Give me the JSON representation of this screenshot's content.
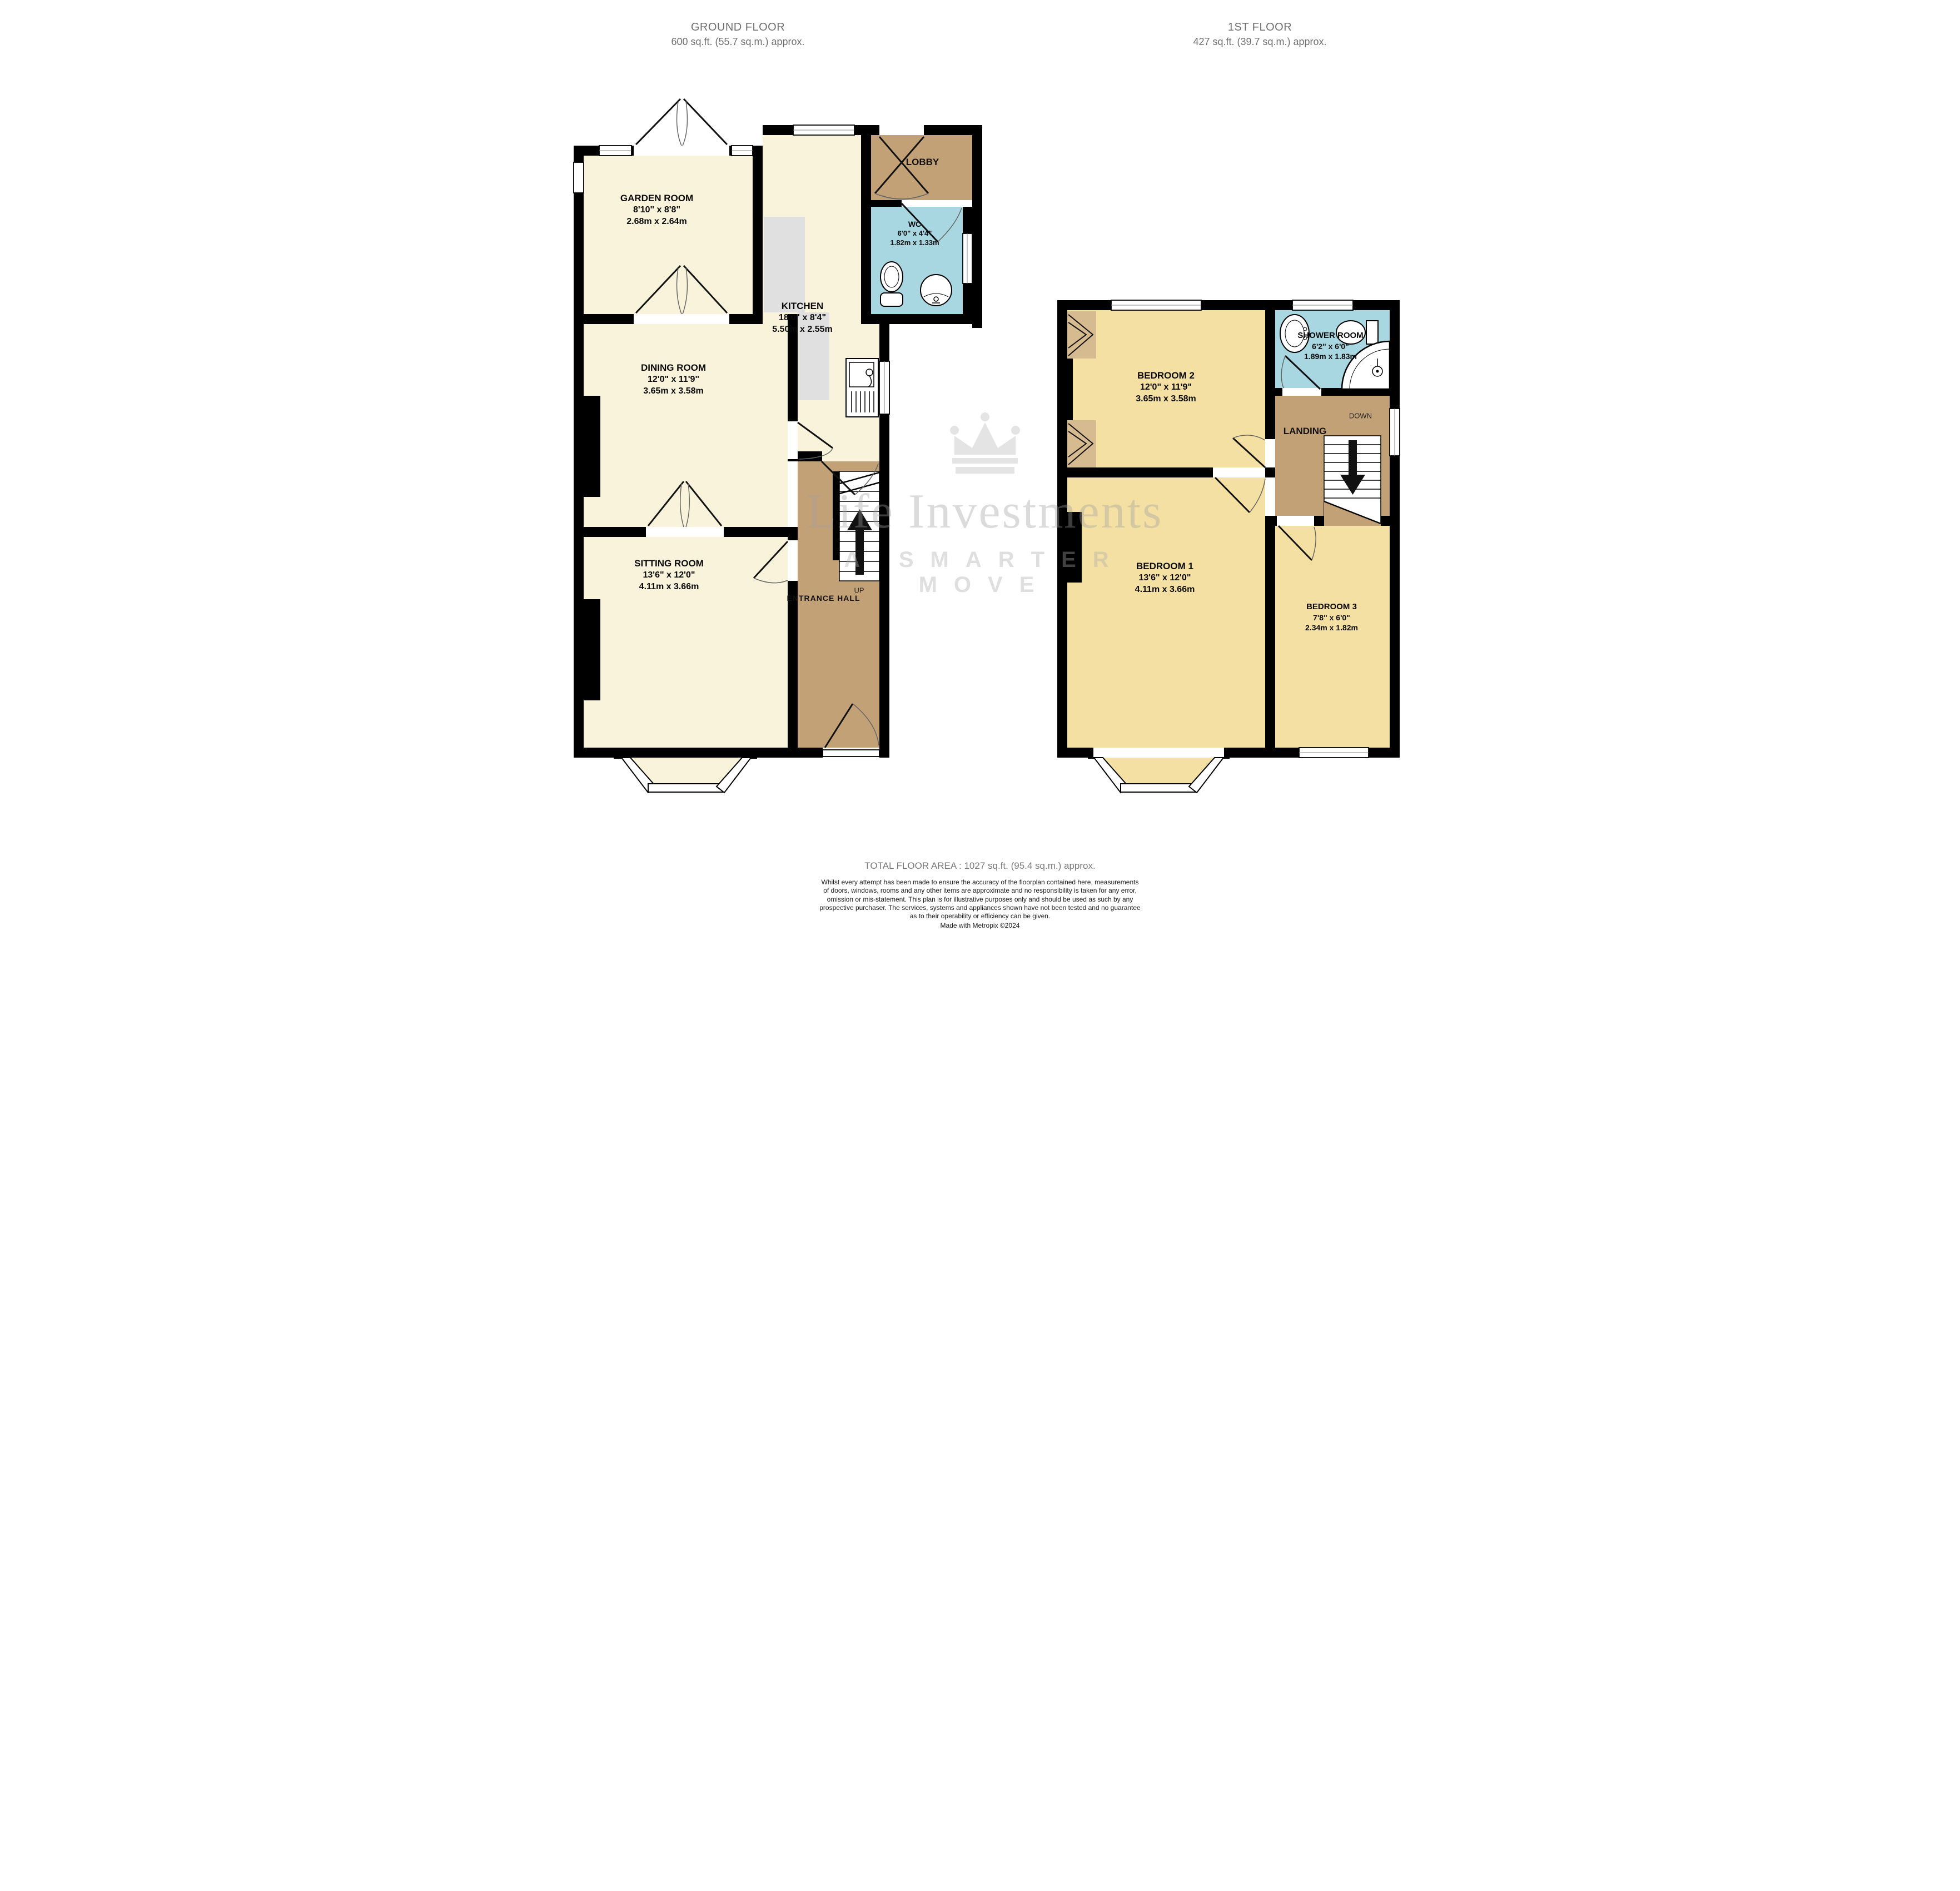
{
  "headers": {
    "ground": {
      "title": "GROUND FLOOR",
      "area": "600 sq.ft. (55.7 sq.m.) approx."
    },
    "first": {
      "title": "1ST FLOOR",
      "area": "427 sq.ft. (39.7 sq.m.) approx."
    }
  },
  "ground_floor": {
    "garden_room": {
      "name": "GARDEN ROOM",
      "imperial": "8'10\"  x 8'8\"",
      "metric": "2.68m  x 2.64m"
    },
    "dining_room": {
      "name": "DINING ROOM",
      "imperial": "12'0\"  x 11'9\"",
      "metric": "3.65m  x 3.58m"
    },
    "sitting_room": {
      "name": "SITTING ROOM",
      "imperial": "13'6\"  x 12'0\"",
      "metric": "4.11m  x 3.66m"
    },
    "kitchen": {
      "name": "KITCHEN",
      "imperial": "18'0\"  x 8'4\"",
      "metric": "5.50m  x 2.55m"
    },
    "wc": {
      "name": "WC",
      "imperial": "6'0\"  x 4'4\"",
      "metric": "1.82m  x 1.33m"
    },
    "lobby": "LOBBY",
    "entrance_hall": "ENTRANCE HALL",
    "up": "UP"
  },
  "first_floor": {
    "bedroom1": {
      "name": "BEDROOM 1",
      "imperial": "13'6\"  x 12'0\"",
      "metric": "4.11m  x 3.66m"
    },
    "bedroom2": {
      "name": "BEDROOM 2",
      "imperial": "12'0\"  x 11'9\"",
      "metric": "3.65m  x 3.58m"
    },
    "bedroom3": {
      "name": "BEDROOM 3",
      "imperial": "7'8\"  x 6'0\"",
      "metric": "2.34m  x 1.82m"
    },
    "shower_room": {
      "name": "SHOWER ROOM",
      "imperial": "6'2\"  x 6'0\"",
      "metric": "1.89m  x 1.83m"
    },
    "landing": "LANDING",
    "down": "DOWN"
  },
  "watermark": {
    "brand": "Life Investments",
    "tagline": "A SMARTER MOVE"
  },
  "footer": {
    "total_area": "TOTAL FLOOR AREA : 1027 sq.ft. (95.4 sq.m.) approx.",
    "disclaimer_lines": [
      "Whilst every attempt has been made to ensure the accuracy of the floorplan contained here, measurements",
      "of doors, windows, rooms and any other items are approximate and no responsibility is taken for any error,",
      "omission or mis-statement. This plan is for illustrative purposes only and should be used as such by any",
      "prospective purchaser. The services, systems and appliances shown have not been tested and no guarantee",
      "as to their operability or efficiency can be given."
    ],
    "credit": "Made with Metropix ©2024"
  }
}
